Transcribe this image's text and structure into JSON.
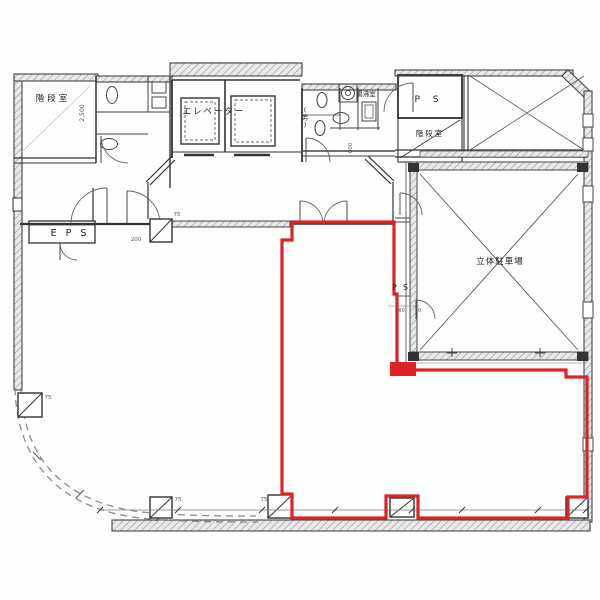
{
  "meta": {
    "kind": "architectural floor plan (scanned)",
    "paper_color": "#fefefe",
    "ink_color": "#3a3a3a",
    "thin_ink_color": "#777777"
  },
  "labels": [
    {
      "id": "stairwell-upper-left",
      "text": "階段室",
      "x": 53,
      "y": 101,
      "size": 8.5,
      "spacing": 3
    },
    {
      "id": "elevator",
      "text": "エレベーター",
      "x": 214,
      "y": 114,
      "size": 8.5,
      "spacing": 2
    },
    {
      "id": "kitchenette",
      "text": "湯沸室",
      "x": 366,
      "y": 96,
      "size": 6.5,
      "spacing": 0
    },
    {
      "id": "mens-wc",
      "text": "(男)",
      "x": 305,
      "y": 112,
      "size": 6.5,
      "stack": true
    },
    {
      "id": "pipe-shaft-upper-right",
      "text": "P S",
      "x": 429,
      "y": 102,
      "size": 9,
      "spacing": 5
    },
    {
      "id": "stairwell-right",
      "text": "階段室",
      "x": 430,
      "y": 136,
      "size": 7.5,
      "spacing": 2
    },
    {
      "id": "parking",
      "text": "立体駐車場",
      "x": 500,
      "y": 264,
      "size": 8.5,
      "spacing": 1
    },
    {
      "id": "pipe-shaft-mid",
      "text": "P S",
      "x": 401,
      "y": 290,
      "size": 7.5,
      "spacing": 2
    },
    {
      "id": "eps",
      "text": "E P S",
      "x": 70,
      "y": 236,
      "size": 9.5,
      "spacing": 3
    }
  ],
  "annotations": [
    {
      "text": "2,500",
      "x": 84,
      "y": 113,
      "size": 6,
      "rotate": -90
    },
    {
      "text": "600",
      "x": 352,
      "y": 148,
      "size": 5.5,
      "rotate": -90
    },
    {
      "text": "200",
      "x": 136,
      "y": 241,
      "size": 5.5
    },
    {
      "text": "75",
      "x": 177,
      "y": 216,
      "size": 5.5
    },
    {
      "text": "75",
      "x": 48,
      "y": 399,
      "size": 5.5
    },
    {
      "text": "75",
      "x": 178,
      "y": 501,
      "size": 5.5
    },
    {
      "text": "75",
      "x": 264,
      "y": 501,
      "size": 5.5
    },
    {
      "text": "160",
      "x": 400,
      "y": 312,
      "size": 5
    },
    {
      "text": "20",
      "x": 418,
      "y": 312,
      "size": 5
    }
  ],
  "highlight": {
    "label": "tenant-area-outline",
    "color": "#dd2424",
    "stroke_width": 3.2,
    "points": [
      [
        292,
        222
      ],
      [
        394,
        222
      ],
      [
        394,
        294
      ],
      [
        397,
        294
      ],
      [
        397,
        370
      ],
      [
        566,
        370
      ],
      [
        566,
        377
      ],
      [
        587,
        377
      ],
      [
        587,
        497
      ],
      [
        568,
        497
      ],
      [
        568,
        518
      ],
      [
        418,
        518
      ],
      [
        418,
        496
      ],
      [
        386,
        496
      ],
      [
        386,
        518
      ],
      [
        292,
        518
      ],
      [
        292,
        494
      ],
      [
        282,
        494
      ],
      [
        282,
        240
      ],
      [
        292,
        240
      ]
    ],
    "blocks": [
      {
        "x": 390,
        "y": 362,
        "w": 26,
        "h": 14
      }
    ]
  }
}
